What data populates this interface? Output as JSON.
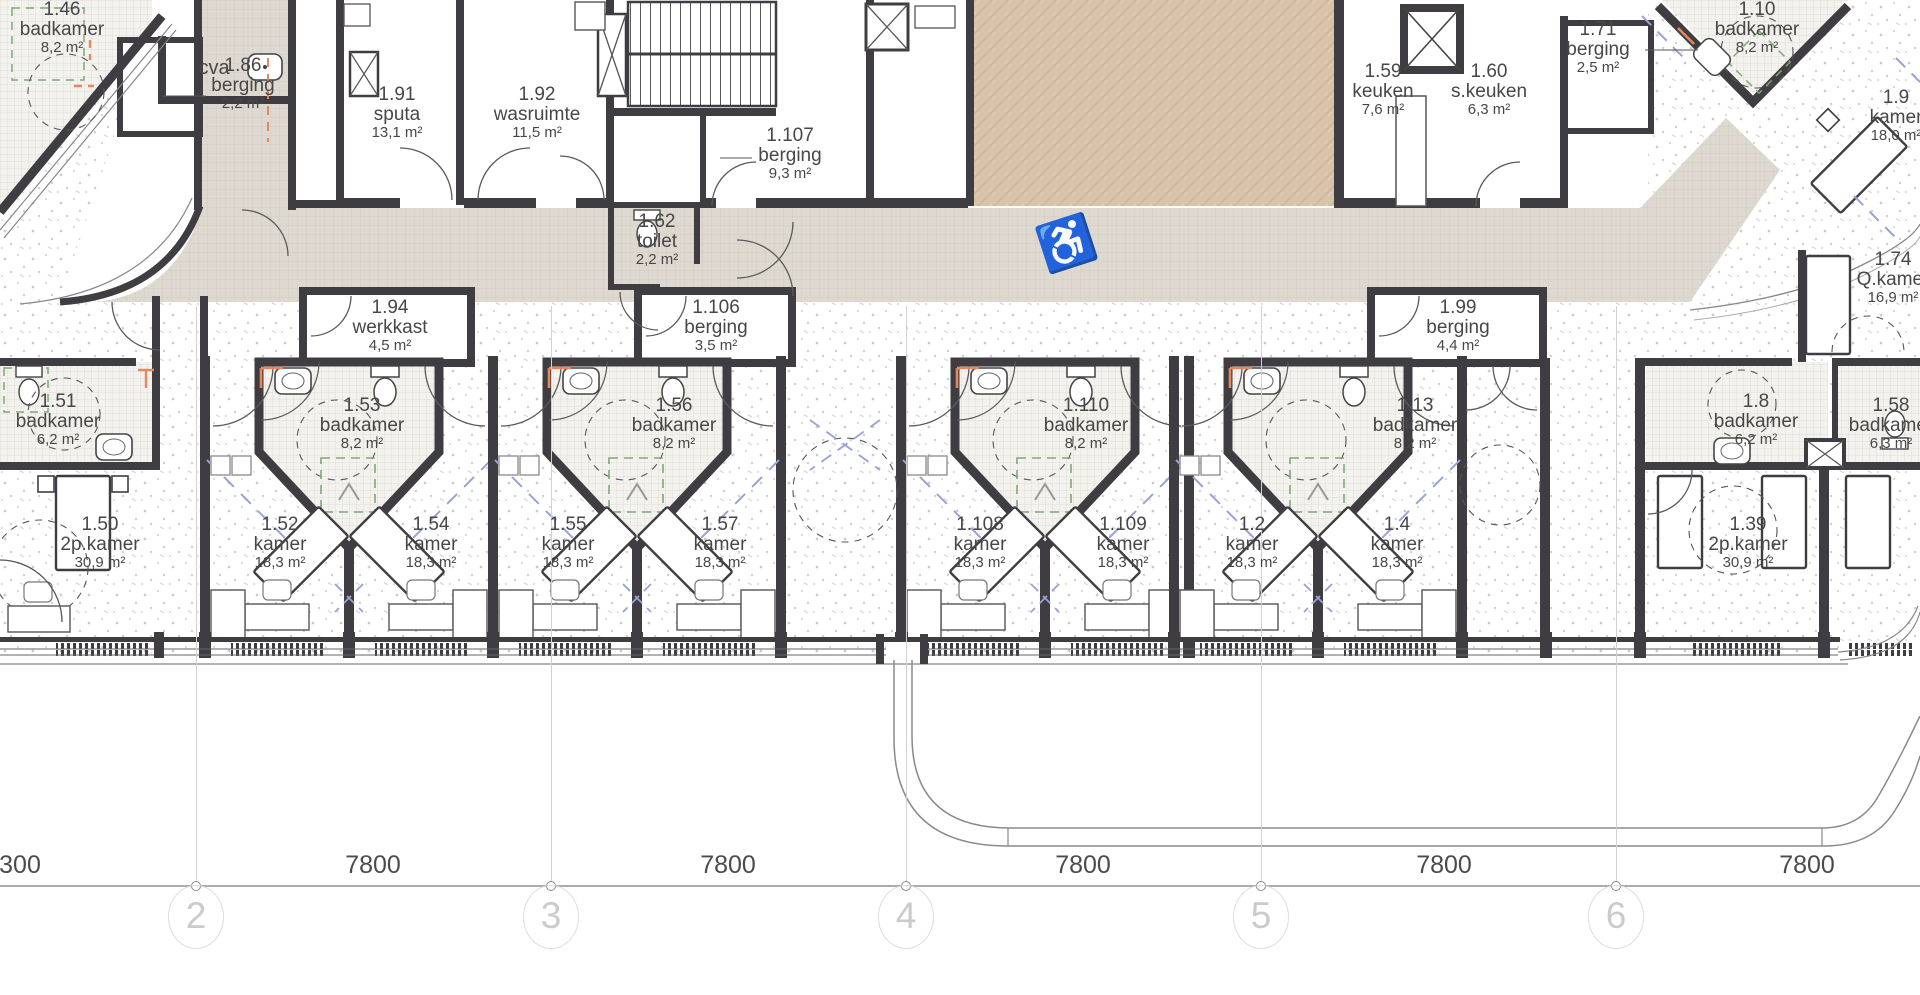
{
  "plan": {
    "title": "floor plan level 1",
    "units": "m²",
    "rooms": [
      {
        "id": "1.46",
        "name": "badkamer",
        "area": "8,2 m²",
        "x": 62,
        "y": 0
      },
      {
        "name": "cva",
        "x": 214,
        "y": 58,
        "single": true
      },
      {
        "id": "1.86",
        "name": "berging",
        "area": "2,2 m²",
        "x": 243,
        "y": 56
      },
      {
        "id": "1.91",
        "name": "sputa",
        "area": "13,1 m²",
        "x": 397,
        "y": 85
      },
      {
        "id": "1.92",
        "name": "wasruimte",
        "area": "11,5 m²",
        "x": 537,
        "y": 85
      },
      {
        "id": "1.107",
        "name": "berging",
        "area": "9,3 m²",
        "x": 790,
        "y": 126
      },
      {
        "id": "1.62",
        "name": "toilet",
        "area": "2,2 m²",
        "x": 657,
        "y": 212
      },
      {
        "id": "1.59",
        "name": "keuken",
        "area": "7,6 m²",
        "x": 1383,
        "y": 62
      },
      {
        "id": "1.60",
        "name": "s.keuken",
        "area": "6,3 m²",
        "x": 1489,
        "y": 62
      },
      {
        "id": "1.71",
        "name": "berging",
        "area": "2,5 m²",
        "x": 1598,
        "y": 20
      },
      {
        "id": "1.10",
        "name": "badkamer",
        "area": "8,2 m²",
        "x": 1757,
        "y": 0
      },
      {
        "id": "1.9",
        "name": "kamer",
        "area": "18,0 m²",
        "x": 1896,
        "y": 88
      },
      {
        "id": "1.74",
        "name": "Q.kamer",
        "area": "16,9 m²",
        "x": 1893,
        "y": 250
      },
      {
        "id": "1.94",
        "name": "werkkast",
        "area": "4,5 m²",
        "x": 390,
        "y": 298
      },
      {
        "id": "1.106",
        "name": "berging",
        "area": "3,5 m²",
        "x": 716,
        "y": 298
      },
      {
        "id": "1.99",
        "name": "berging",
        "area": "4,4 m²",
        "x": 1458,
        "y": 298
      },
      {
        "id": "1.51",
        "name": "badkamer",
        "area": "6,2 m²",
        "x": 58,
        "y": 392
      },
      {
        "id": "1.53",
        "name": "badkamer",
        "area": "8,2 m²",
        "x": 362,
        "y": 396
      },
      {
        "id": "1.56",
        "name": "badkamer",
        "area": "8,2 m²",
        "x": 674,
        "y": 396
      },
      {
        "id": "1.110",
        "name": "badkamer",
        "area": "8,2 m²",
        "x": 1086,
        "y": 396
      },
      {
        "id": "1.13",
        "name": "badkamer",
        "area": "8,2 m²",
        "x": 1415,
        "y": 396
      },
      {
        "id": "1.8",
        "name": "badkamer",
        "area": "6,2 m²",
        "x": 1756,
        "y": 392
      },
      {
        "id": "1.58",
        "name": "badkamer",
        "area": "6,3 m²",
        "x": 1891,
        "y": 396
      },
      {
        "id": "1.50",
        "name": "2p.kamer",
        "area": "30,9 m²",
        "x": 100,
        "y": 515
      },
      {
        "id": "1.52",
        "name": "kamer",
        "area": "18,3 m²",
        "x": 280,
        "y": 515
      },
      {
        "id": "1.54",
        "name": "kamer",
        "area": "18,3 m²",
        "x": 431,
        "y": 515
      },
      {
        "id": "1.55",
        "name": "kamer",
        "area": "18,3 m²",
        "x": 568,
        "y": 515
      },
      {
        "id": "1.57",
        "name": "kamer",
        "area": "18,3 m²",
        "x": 720,
        "y": 515
      },
      {
        "id": "1.108",
        "name": "kamer",
        "area": "18,3 m²",
        "x": 980,
        "y": 515
      },
      {
        "id": "1.109",
        "name": "kamer",
        "area": "18,3 m²",
        "x": 1123,
        "y": 515
      },
      {
        "id": "1.2",
        "name": "kamer",
        "area": "18,3 m²",
        "x": 1252,
        "y": 515
      },
      {
        "id": "1.4",
        "name": "kamer",
        "area": "18,3 m²",
        "x": 1397,
        "y": 515
      },
      {
        "id": "1.39",
        "name": "2p.kamer",
        "area": "30,9 m²",
        "x": 1748,
        "y": 515
      }
    ],
    "grid": {
      "bubbles": [
        {
          "label": "2",
          "x": 196
        },
        {
          "label": "3",
          "x": 551
        },
        {
          "label": "4",
          "x": 906
        },
        {
          "label": "5",
          "x": 1261
        },
        {
          "label": "6",
          "x": 1616
        }
      ],
      "dimensions": [
        {
          "text": "300",
          "x": 20
        },
        {
          "text": "7800",
          "x": 373
        },
        {
          "text": "7800",
          "x": 728
        },
        {
          "text": "7800",
          "x": 1083
        },
        {
          "text": "7800",
          "x": 1444
        },
        {
          "text": "7800",
          "x": 1807
        }
      ]
    },
    "colors": {
      "wall": "#3f3d41",
      "corridor_floor": "#ded9d0",
      "dining_floor": "#d8c3ab",
      "escape_route_blue": "#98a2da",
      "door_mark_orange": "#e28a5e",
      "shower_green": "#7fa878"
    }
  }
}
